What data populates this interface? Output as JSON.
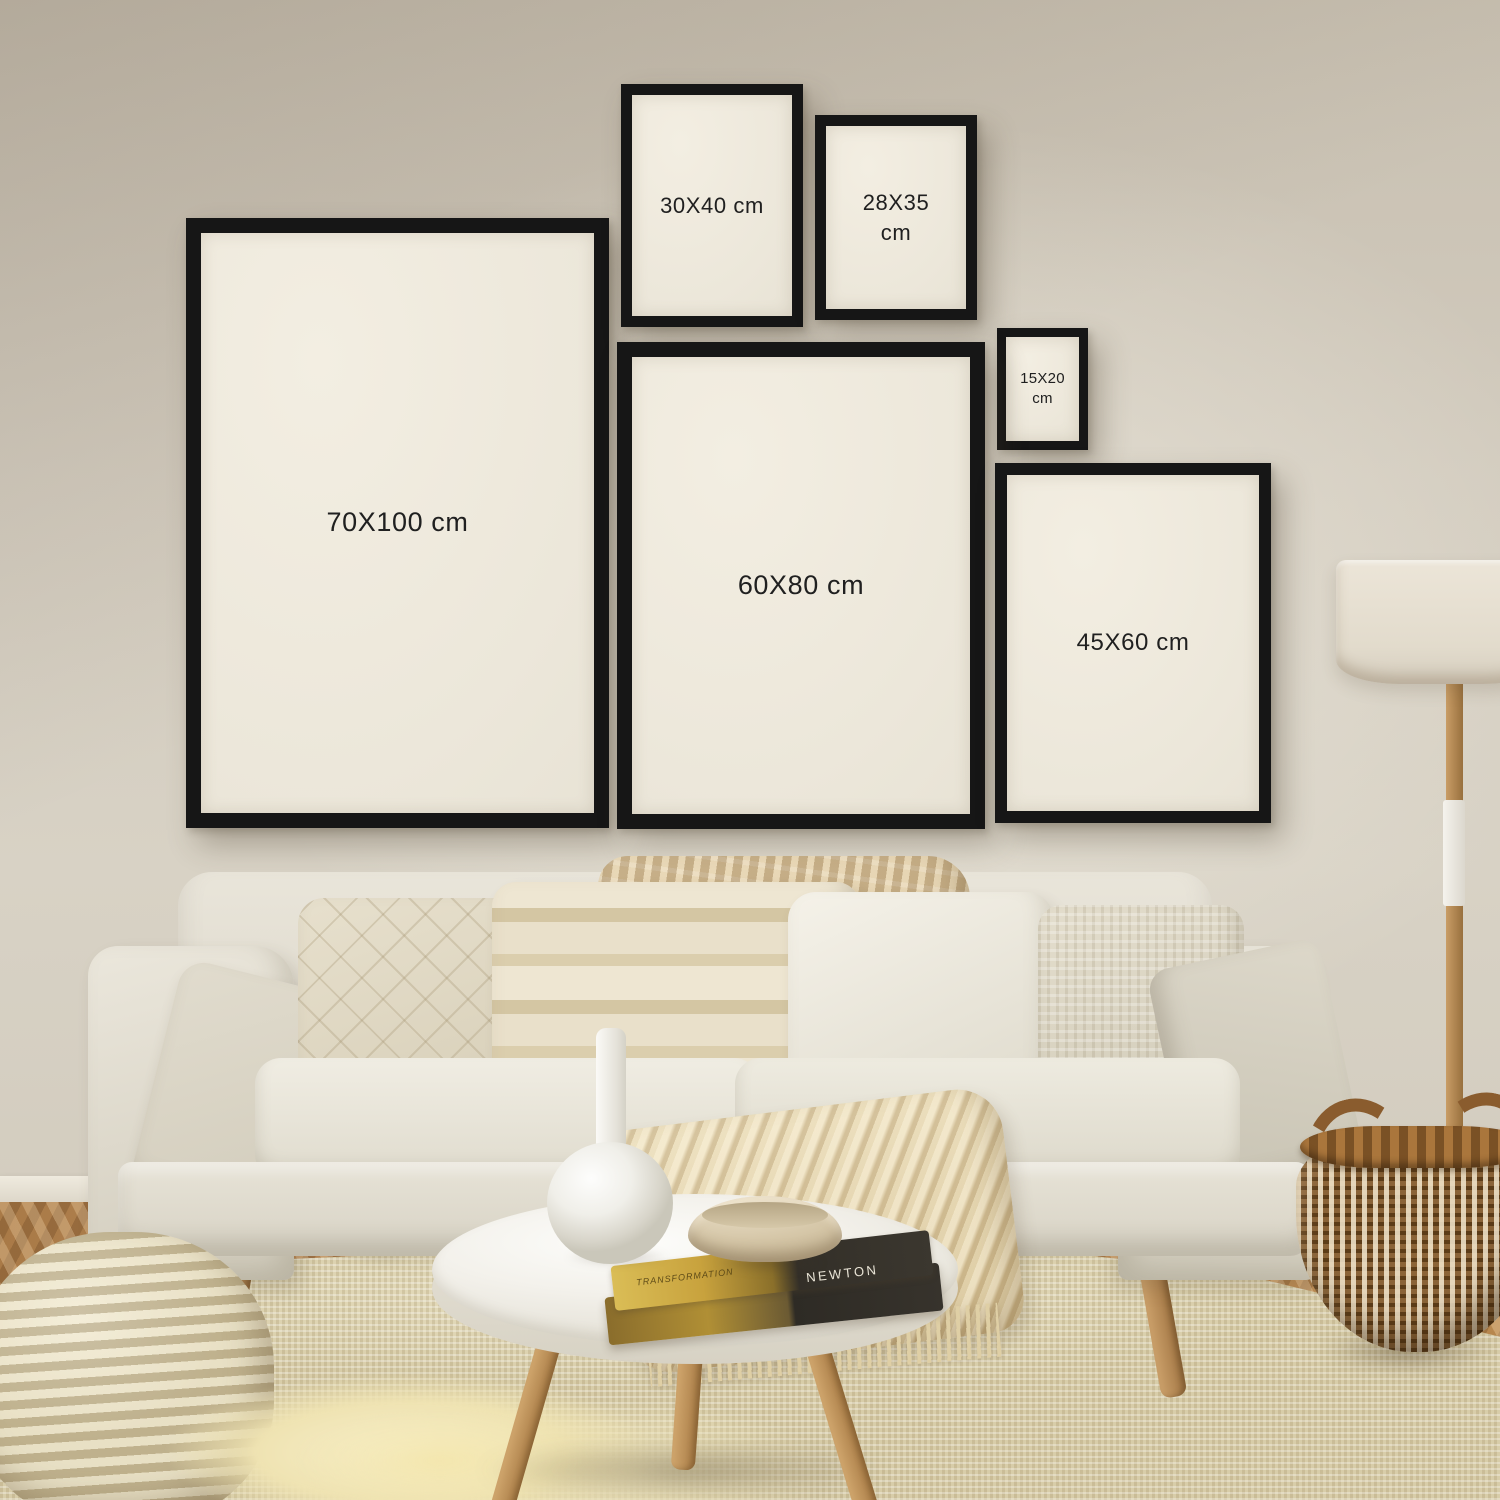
{
  "frames": {
    "f70x100": {
      "label": "70X100 cm"
    },
    "f60x80": {
      "label": "60X80 cm"
    },
    "f45x60": {
      "label": "45X60 cm"
    },
    "f30x40": {
      "label": "30X40 cm"
    },
    "f28x35": {
      "label": "28X35 cm"
    },
    "f15x20": {
      "label": "15X20 cm"
    }
  },
  "book": {
    "spine_title": "NEWTON",
    "cover_text": "TRANSFORMATION"
  },
  "palette": {
    "wall": "#d2cbbe",
    "frame_border": "#161616",
    "frame_mat": "#efeadd",
    "label_text": "#202020",
    "wood": "#b9854f",
    "rug": "#d8cda9",
    "sofa": "#e3ded2",
    "basket_brown": "#6f4c27",
    "book_gold": "#c8a23d"
  }
}
